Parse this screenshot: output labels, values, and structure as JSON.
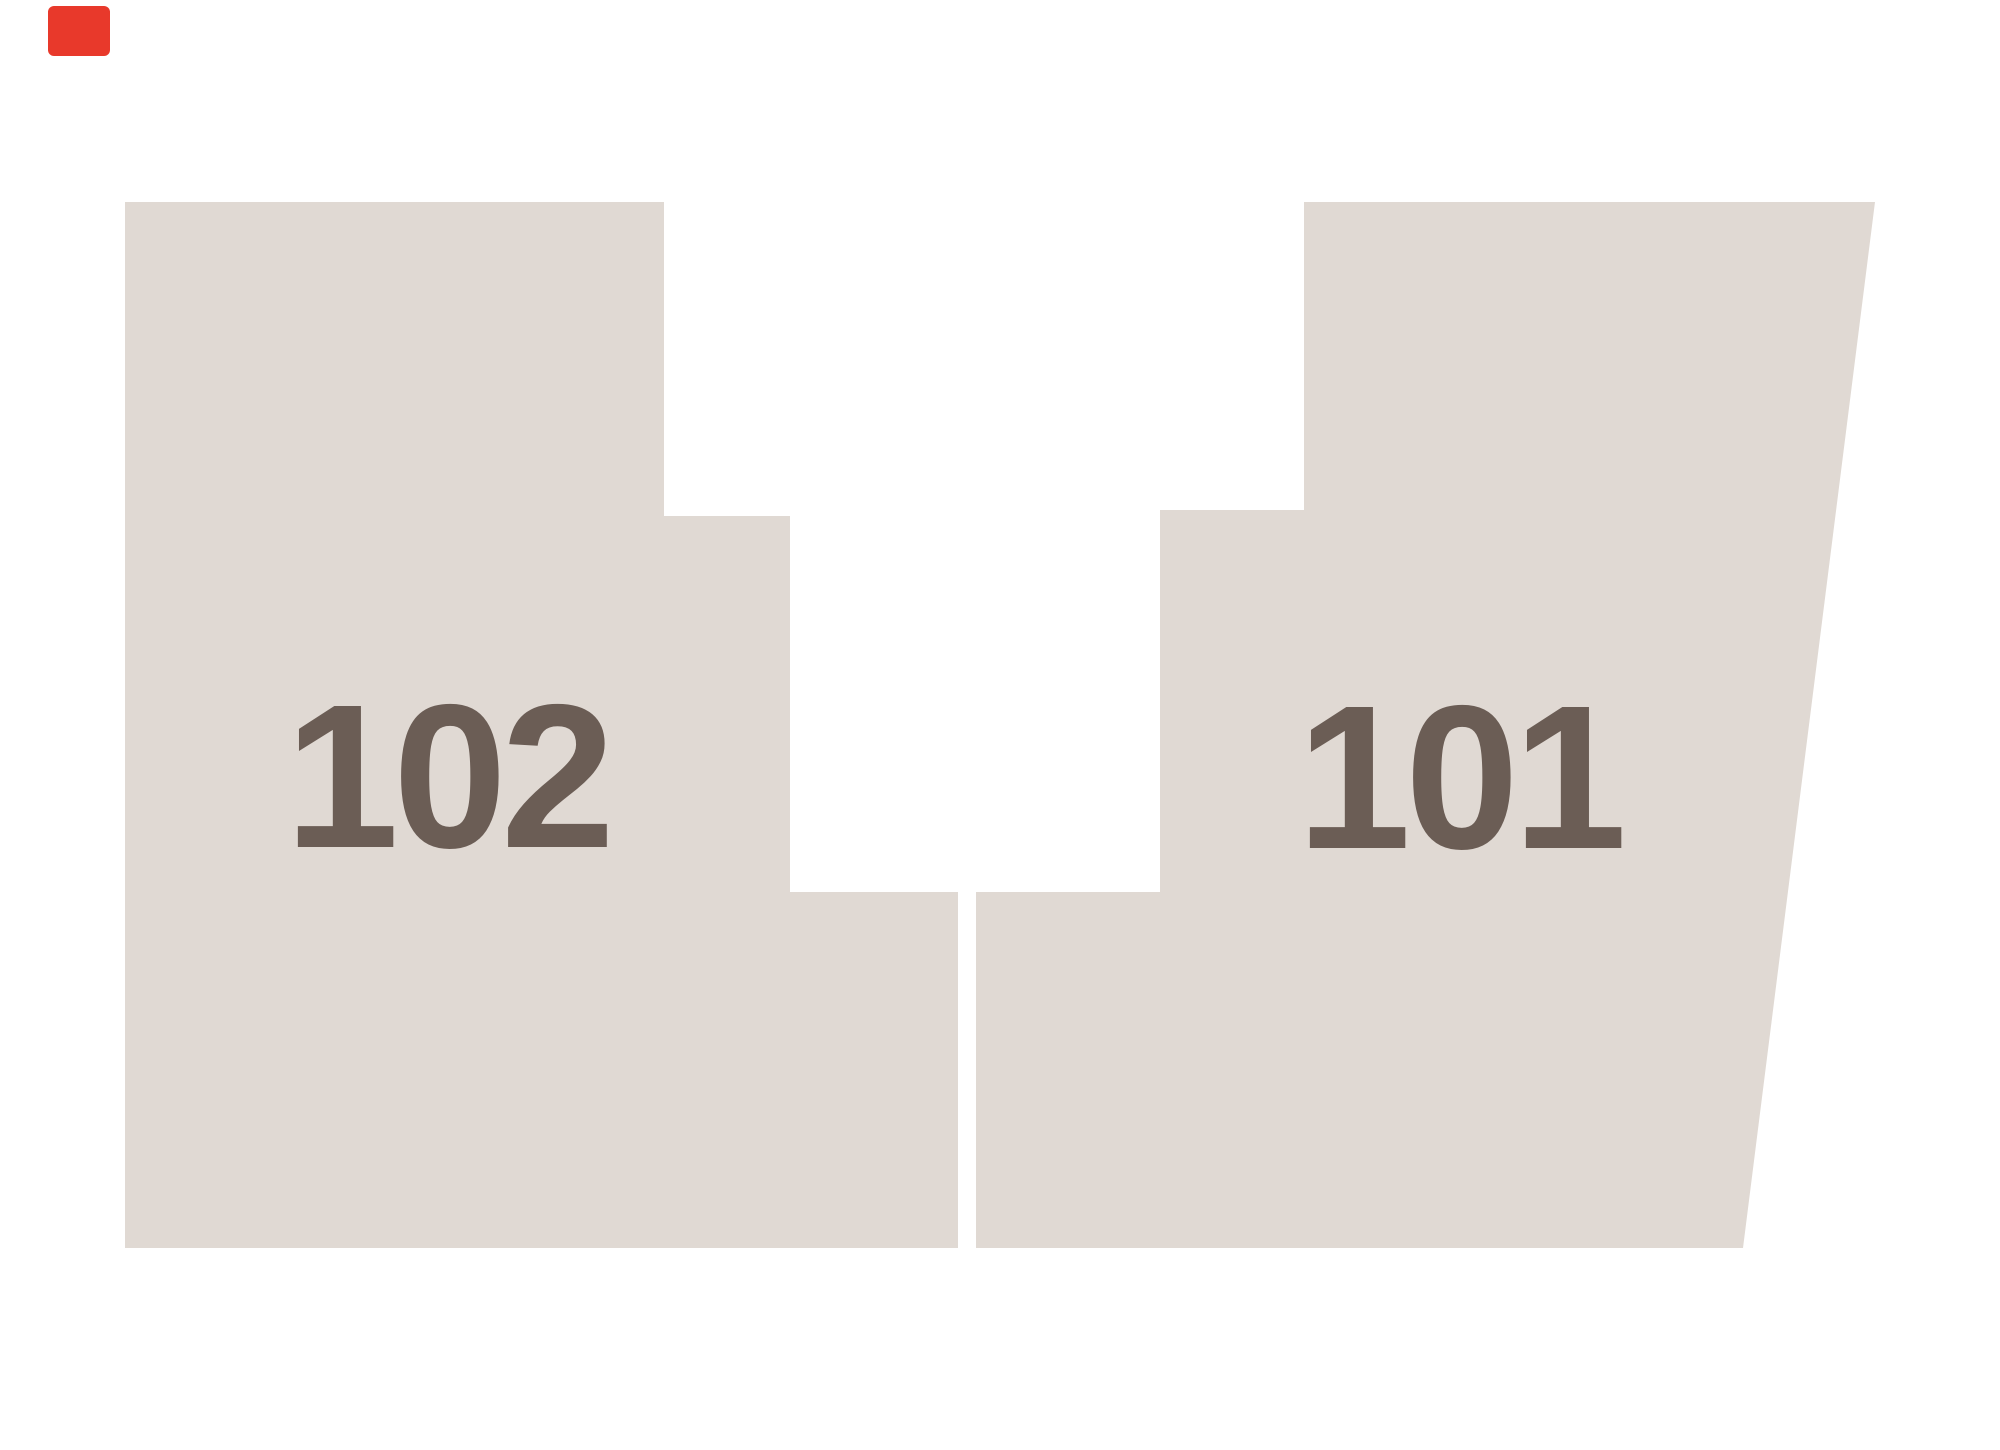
{
  "canvas": {
    "width": 2000,
    "height": 1450,
    "background_color": "#ffffff"
  },
  "map": {
    "shape_fill_color": "#e0d9d3",
    "label_color": "#6b5d55",
    "marker_color": "#e8392b",
    "lots": [
      {
        "label": "102",
        "points": "125,202 664,202 664,516 790,516 790,892 958,892 958,1248 125,1248"
      },
      {
        "label": "101",
        "points": "1304,202 1875,202 1743,1248 976,1248 976,892 1160,892 1160,510 1304,510"
      }
    ]
  }
}
